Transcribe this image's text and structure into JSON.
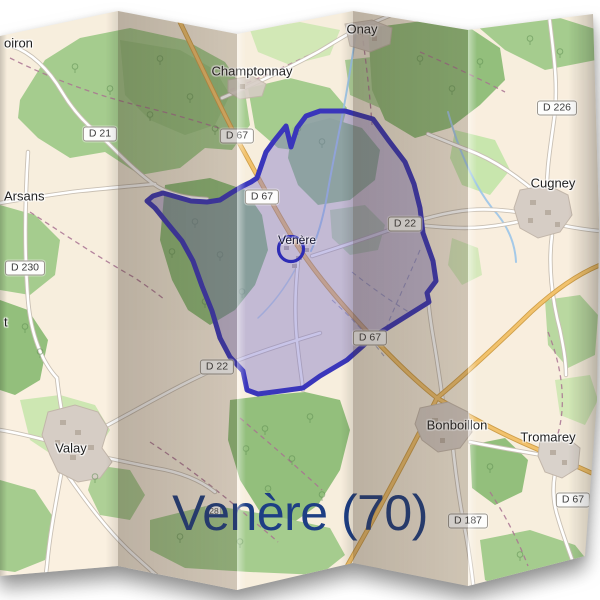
{
  "title": "Venère (70)",
  "map": {
    "marker": {
      "label": "Venère"
    },
    "towns": [
      {
        "name": "oiron"
      },
      {
        "name": "Champtonnay"
      },
      {
        "name": "Onay"
      },
      {
        "name": "Cugney"
      },
      {
        "name": "Arsans"
      },
      {
        "name": "t"
      },
      {
        "name": "Valay"
      },
      {
        "name": "Bonboillon"
      },
      {
        "name": "Tromarey"
      }
    ],
    "road_shields": [
      {
        "label": "D 21"
      },
      {
        "label": "D 67"
      },
      {
        "label": "D 226"
      },
      {
        "label": "D 67"
      },
      {
        "label": "D 22"
      },
      {
        "label": "D 230"
      },
      {
        "label": "D 22"
      },
      {
        "label": "D 67"
      },
      {
        "label": "D 187"
      },
      {
        "label": "D 67"
      },
      {
        "label": "28"
      }
    ],
    "colors": {
      "boundary_stroke": "#3a36bb",
      "boundary_fill": "#7d73c8",
      "title_color": "#1d3e84",
      "land": "#f7eedd",
      "forest": "#a5cc8e",
      "road_orange": "#f2c26c"
    }
  }
}
